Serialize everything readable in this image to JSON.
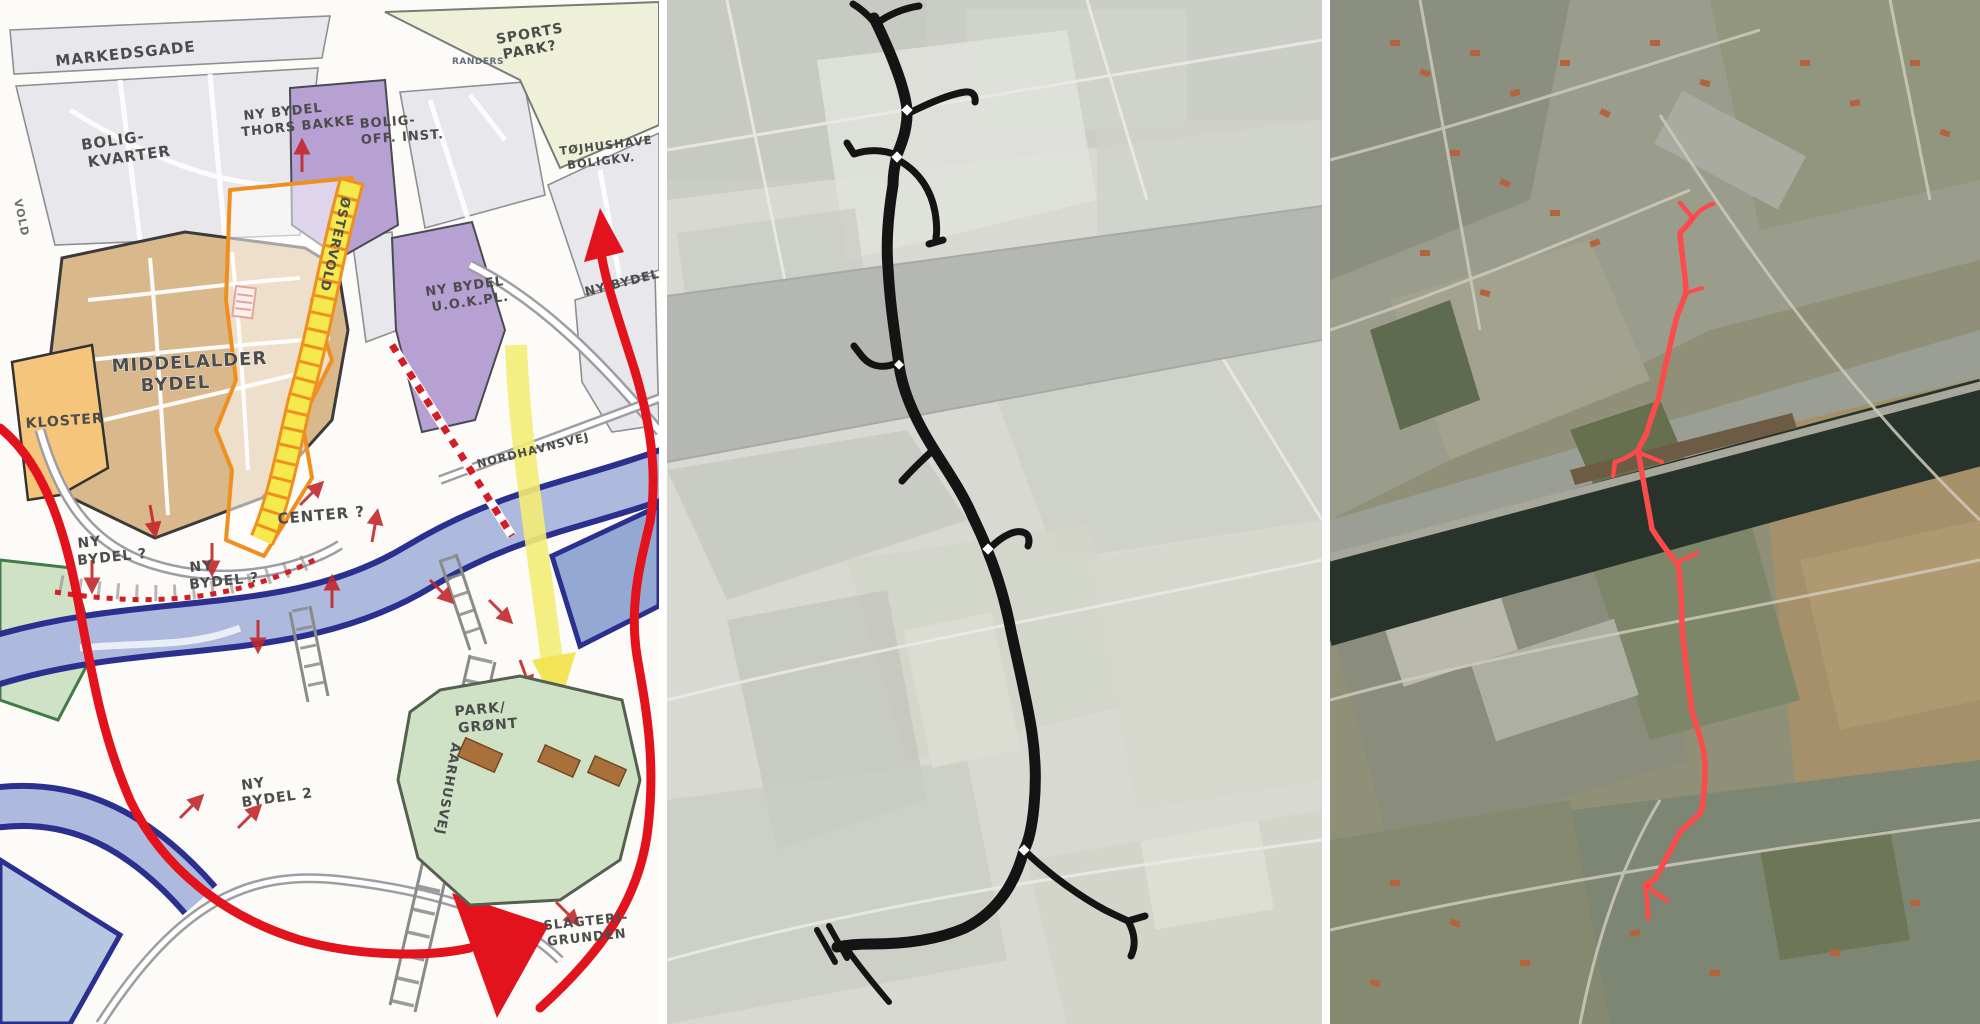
{
  "sketch": {
    "labels": {
      "markedsgade": {
        "text": "MARKEDSGADE"
      },
      "bolig_kvarter": {
        "lines": [
          "BOLIG-",
          "KVARTER"
        ]
      },
      "thors_bakke": {
        "lines": [
          "NY BYDEL",
          "THORS BAKKE"
        ]
      },
      "randers": {
        "text": "RANDERS"
      },
      "sports_park": {
        "lines": [
          "SPORTS",
          "PARK?"
        ]
      },
      "bolig_off_inst": {
        "lines": [
          "BOLIG-",
          "OFF. INST."
        ]
      },
      "tojhushave": {
        "lines": [
          "TØJHUSHAVE",
          "BOLIGKV."
        ]
      },
      "kloster": {
        "text": "KLOSTER"
      },
      "middelalder": {
        "lines": [
          "MIDDELALDER",
          "BYDEL"
        ]
      },
      "ostervold": {
        "text": "ØSTERVOLD"
      },
      "center": {
        "text": "CENTER ?"
      },
      "ny_bydel_vokpl": {
        "lines": [
          "NY BYDEL",
          "U.O.K.PL."
        ]
      },
      "ny_bydel_right": {
        "text": "NY BYDEL"
      },
      "nordhavnsvej": {
        "text": "NORDHAVNSVEJ"
      },
      "ny_bydel_q1": {
        "lines": [
          "NY",
          "BYDEL ?"
        ]
      },
      "ny_bydel_q2": {
        "lines": [
          "NY",
          "BYDEL ?"
        ]
      },
      "ny_bydel_2": {
        "lines": [
          "NY",
          "BYDEL 2"
        ]
      },
      "park_gront": {
        "lines": [
          "PARK/",
          "GRØNT"
        ]
      },
      "aarhusvej": {
        "text": "AARHUSVEJ"
      },
      "slagteri_grunden": {
        "lines": [
          "SLAGTERI-",
          "GRUNDEN"
        ]
      },
      "vold": {
        "text": "VOLD"
      }
    }
  },
  "colors": {
    "sketch_route_red": "#e2131c",
    "sketch_corridor_orange": "#ef8f1f",
    "sketch_corridor_yellow": "#f5e94e",
    "sketch_water_navy": "#2b2f8e",
    "sketch_water_fill": "#adbade",
    "sketch_park_green": "#cfe2c6",
    "sketch_medieval_tan": "#d9b88c",
    "sketch_zone_purple": "#b7a0d2",
    "alignment_black": "#141414",
    "aerial_route_red": "#fb4b4b"
  }
}
